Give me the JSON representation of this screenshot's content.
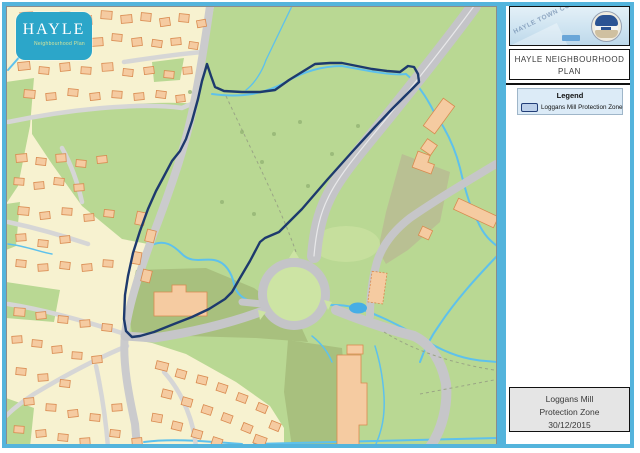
{
  "logo": {
    "title": "HAYLE",
    "subtitle": "Neighbourhood Plan"
  },
  "sidebar": {
    "stamp": {
      "watermark": "HAYLE TOWN COUNCIL"
    },
    "title": {
      "line1": "HAYLE NEIGHBOURHOOD",
      "line2": "PLAN"
    },
    "legend": {
      "heading": "Legend",
      "items": [
        {
          "label": "Loggans Mill Protection Zone",
          "swatch_fill": "#bcd0ea",
          "swatch_border": "#223e78"
        }
      ]
    },
    "footer": {
      "lines": [
        "Loggans Mill",
        "Protection Zone",
        "30/12/2015"
      ]
    }
  },
  "map": {
    "zone_name": "Loggans Mill Protection Zone",
    "colors": {
      "frame_blue": "#54b4dc",
      "zone_boundary": "#1d3a6d",
      "field_green": "#b9d893",
      "residential_cream": "#f7f2d0",
      "building_fill": "#f5cba1",
      "building_stroke": "#d98a4f",
      "road_grey": "#c6c6c9",
      "water_blue": "#5ec1ec",
      "logo_teal": "#2ca6c9"
    }
  }
}
